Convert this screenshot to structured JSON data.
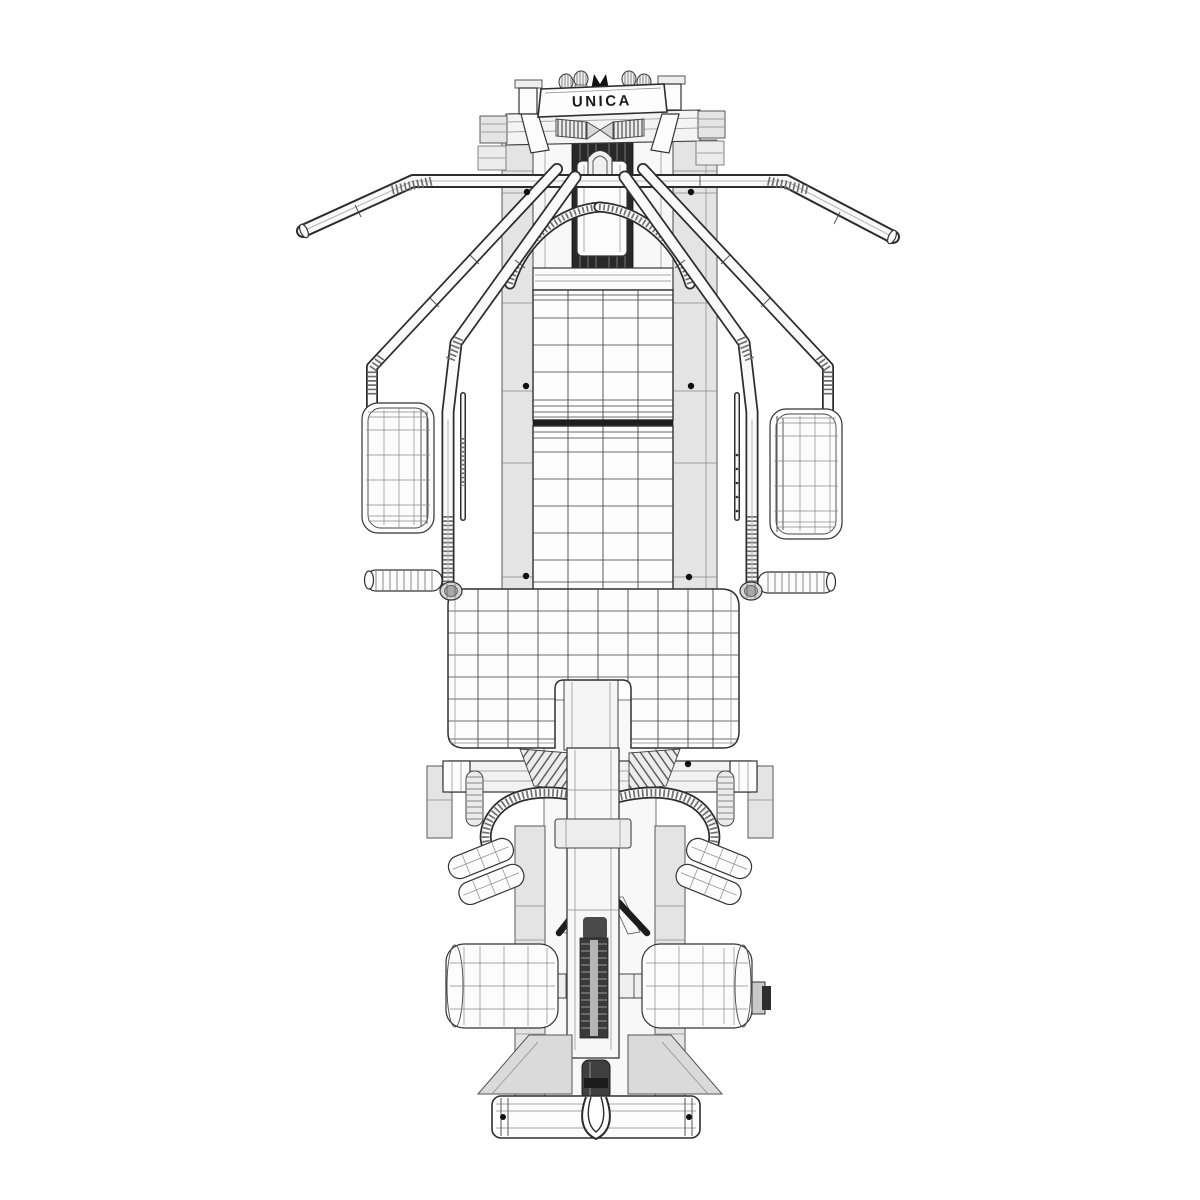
{
  "scene": {
    "style": "3d-wireframe-render",
    "view": "top",
    "subject": "multi-station home gym machine",
    "background": "#ffffff"
  },
  "brand": {
    "label": "UNICA"
  },
  "palette": {
    "line_dark": "#2d2d2d",
    "line_mid": "#4a4a4a",
    "line_soft": "#8a8a8a",
    "fill_white": "#fcfcfc",
    "fill_gray": "#e4e4e4",
    "fill_dark": "#282828"
  }
}
